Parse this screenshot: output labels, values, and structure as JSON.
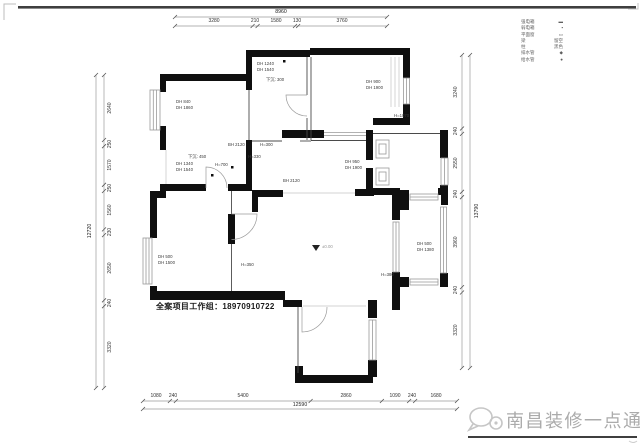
{
  "watermark": {
    "text": "南昌装修一点通"
  },
  "footer": {
    "credit": "全案项目工作组：18970910722"
  },
  "dims": {
    "top": {
      "total": "8960",
      "segs": [
        "3280",
        "210",
        "1580",
        "130",
        "3760"
      ]
    },
    "bottom": {
      "total": "12590",
      "segs": [
        "1080",
        "240",
        "5400",
        "2860",
        "1090",
        "240",
        "1680"
      ]
    },
    "left": {
      "total": "12720",
      "segs": [
        "2640",
        "250",
        "1570",
        "250",
        "1560",
        "230",
        "2650",
        "240",
        "3320"
      ]
    },
    "right": {
      "total": "13790",
      "segs": [
        "3240",
        "240",
        "2550",
        "240",
        "3960",
        "240",
        "3320"
      ]
    }
  },
  "legend": {
    "items": [
      {
        "label": "强电箱",
        "mark": "▬"
      },
      {
        "label": "弱电箱",
        "mark": "▪"
      },
      {
        "label": "平面窗",
        "mark": "▭"
      },
      {
        "label": "梁",
        "mark": "留空"
      },
      {
        "label": "柱",
        "mark": "黑色"
      },
      {
        "label": "排水管",
        "mark": "◆"
      },
      {
        "label": "给水管",
        "mark": "●"
      }
    ]
  },
  "notes": [
    {
      "l1": "DH 840",
      "l2": "DH 1860"
    },
    {
      "l1": "DH 1240",
      "l2": "DH 1540"
    },
    {
      "l1": "下沉: 300"
    },
    {
      "l1": "DH 900",
      "l2": "DH 1900"
    },
    {
      "l1": "BH 2120"
    },
    {
      "l1": "H=300"
    },
    {
      "l1": "H=330"
    },
    {
      "l1": "下沉: 450"
    },
    {
      "l1": "DH 1340",
      "l2": "DH 1540"
    },
    {
      "l1": "H=700"
    },
    {
      "l1": "BH 2120"
    },
    {
      "l1": "DH 950",
      "l2": "DH 1900"
    },
    {
      "l1": "H=1070"
    },
    {
      "l1": "DH 500",
      "l2": "DH 1500"
    },
    {
      "l1": "H=350"
    },
    {
      "l1": "±0.00"
    },
    {
      "l1": "DH 500",
      "l2": "DH 1380"
    },
    {
      "l1": "H=380"
    }
  ]
}
